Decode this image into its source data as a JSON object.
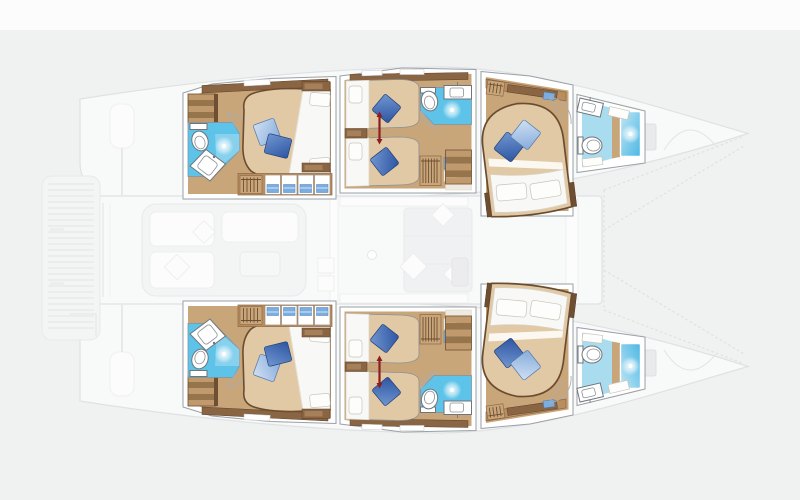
{
  "canvas": {
    "width": 800,
    "height": 500
  },
  "scene": {
    "type": "floor-plan-illustration",
    "subject": "catamaran-lower-deck-cabin-layout",
    "orientation": "bow-pointing-right",
    "highlighted_areas": [
      {
        "name": "top-hull-aft-cabin",
        "fixtures": [
          "double-berth",
          "blue-pillow-pair",
          "white-pillows",
          "ensuite-bathroom",
          "sink",
          "toilet",
          "shower-sparkle",
          "entry-stairs",
          "wardrobe-lockers",
          "hanging-locker",
          "door-swing"
        ]
      },
      {
        "name": "top-hull-mid-cabin",
        "fixtures": [
          "twin-berths",
          "blue-pillows",
          "red-divider-marker",
          "ensuite-bathroom",
          "sink",
          "toilet",
          "shower-sparkle",
          "hanging-locker",
          "stairs-to-saloon",
          "bedside-shelf",
          "door-swing"
        ]
      },
      {
        "name": "top-hull-forward-cabin",
        "fixtures": [
          "angled-double-berth",
          "blue-pillow-pair",
          "white-pillows",
          "wardrobe-shelf",
          "hanging-locker",
          "door-swing"
        ]
      },
      {
        "name": "top-hull-bow-bathroom",
        "fixtures": [
          "sink",
          "toilet",
          "shower-stall",
          "shelf"
        ]
      },
      {
        "name": "bottom-hull-aft-cabin",
        "fixtures": [
          "double-berth",
          "blue-pillow-pair",
          "white-pillows",
          "ensuite-bathroom",
          "sink",
          "toilet",
          "shower-sparkle",
          "entry-stairs",
          "wardrobe-lockers",
          "hanging-locker",
          "door-swing"
        ]
      },
      {
        "name": "bottom-hull-mid-cabin",
        "fixtures": [
          "twin-berths",
          "blue-pillows",
          "red-divider-marker",
          "ensuite-bathroom",
          "sink",
          "toilet",
          "shower-sparkle",
          "hanging-locker",
          "stairs-to-saloon",
          "bedside-shelf",
          "door-swing"
        ]
      },
      {
        "name": "bottom-hull-forward-cabin",
        "fixtures": [
          "angled-double-berth",
          "blue-pillow-pair",
          "white-pillows",
          "wardrobe-shelf",
          "hanging-locker",
          "door-swing"
        ]
      },
      {
        "name": "bottom-hull-bow-bathroom",
        "fixtures": [
          "sink",
          "toilet",
          "shower-stall",
          "shelf"
        ]
      }
    ],
    "ghosted_areas": [
      "aft-swim-platform",
      "transom-beams",
      "helm-pods",
      "aft-cockpit-lounge",
      "saloon-sofa",
      "saloon-table",
      "galley-counters",
      "foredeck-trampoline",
      "bow-anchor-hatches",
      "windlass-lines"
    ]
  },
  "palette": {
    "bg": "#f0f1f1",
    "top_band": "#fcfcfc",
    "ghost_fill": "#f8f9f9",
    "ghost_line": "#dfe1e3",
    "wall_line": "#9aa0a5",
    "wood": "#c9a67a",
    "wood_mid": "#b98e5f",
    "wood_dark": "#8a6543",
    "wood_deep": "#6e4f33",
    "duvet_tan": "#e0c9a4",
    "mattress": "#f8f8f6",
    "bath_blue": "#5ec3e8",
    "bath_blue_light": "#aadcf0",
    "shower_blue": "#4db7e4",
    "shower_blue_light": "#bfe6f5",
    "pillow_dark": "#2e55a2",
    "pillow_dark_hi": "#7096d0",
    "pillow_light": "#86abdc",
    "pillow_light_hi": "#cfe0f2",
    "clothes_blue": "#7aade0",
    "divider_red": "#8e1d1d"
  }
}
